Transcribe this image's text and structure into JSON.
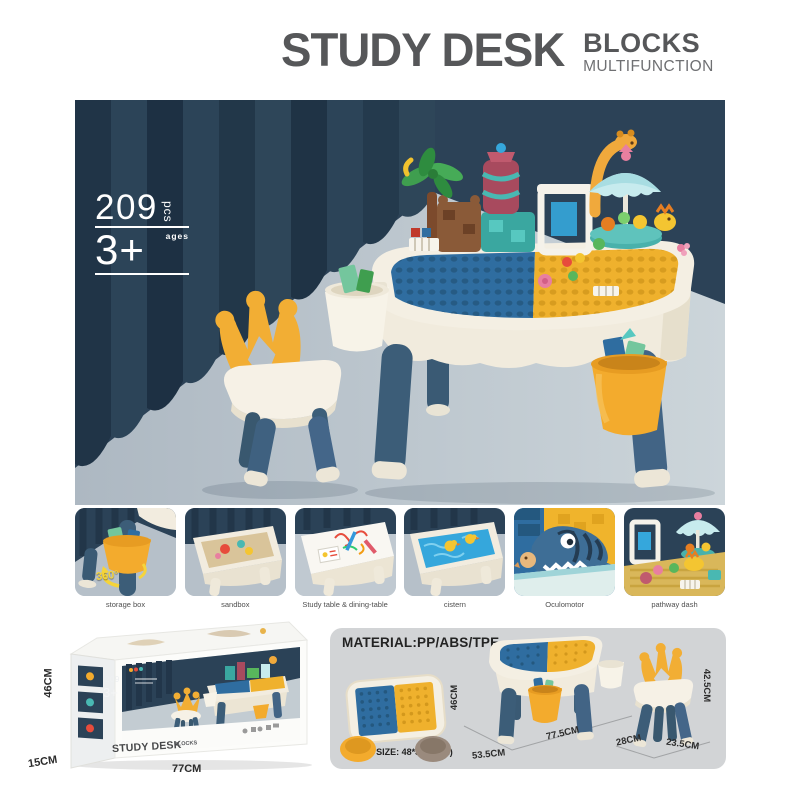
{
  "header": {
    "title": "STUDY DESK",
    "badge": "BLOCKS",
    "subtitle": "MULTIFUNCTION"
  },
  "hero": {
    "pieces": "209",
    "pieces_unit": "pcs",
    "ages_label": "ages",
    "age": "3+"
  },
  "features": [
    {
      "caption": "storage box",
      "badge": "360°"
    },
    {
      "caption": "sandbox"
    },
    {
      "caption": "Study table & dining-table"
    },
    {
      "caption": "cistern"
    },
    {
      "caption": "Oculomotor"
    },
    {
      "caption": "pathway dash"
    }
  ],
  "package_box": {
    "height": "46CM",
    "depth": "15CM",
    "width": "77CM",
    "face": {
      "pieces": "209",
      "age": "3+",
      "title": "STUDY DESK",
      "subtitle": "BLOCKS"
    }
  },
  "specs": {
    "material": "MATERIAL:PP/ABS/TPE",
    "panel_size": "PANEL SIZE: 48*33.5(CM)",
    "table": {
      "height": "46CM",
      "depth": "53.5CM",
      "width": "77.5CM"
    },
    "chair": {
      "seat_width": "28CM",
      "seat_depth": "23.5CM",
      "height": "42.5CM"
    }
  },
  "colors": {
    "title_gray": "#565759",
    "navy": "#2c4257",
    "curtain_dark": "#203447",
    "floor": "#c3ccd3",
    "cream": "#f4efe3",
    "leg_blue": "#3c5d78",
    "plate_blue": "#2f6da0",
    "plate_yellow": "#efb12d",
    "accent_yellow": "#f2ae34",
    "panel_gray": "#d2d4d6"
  }
}
